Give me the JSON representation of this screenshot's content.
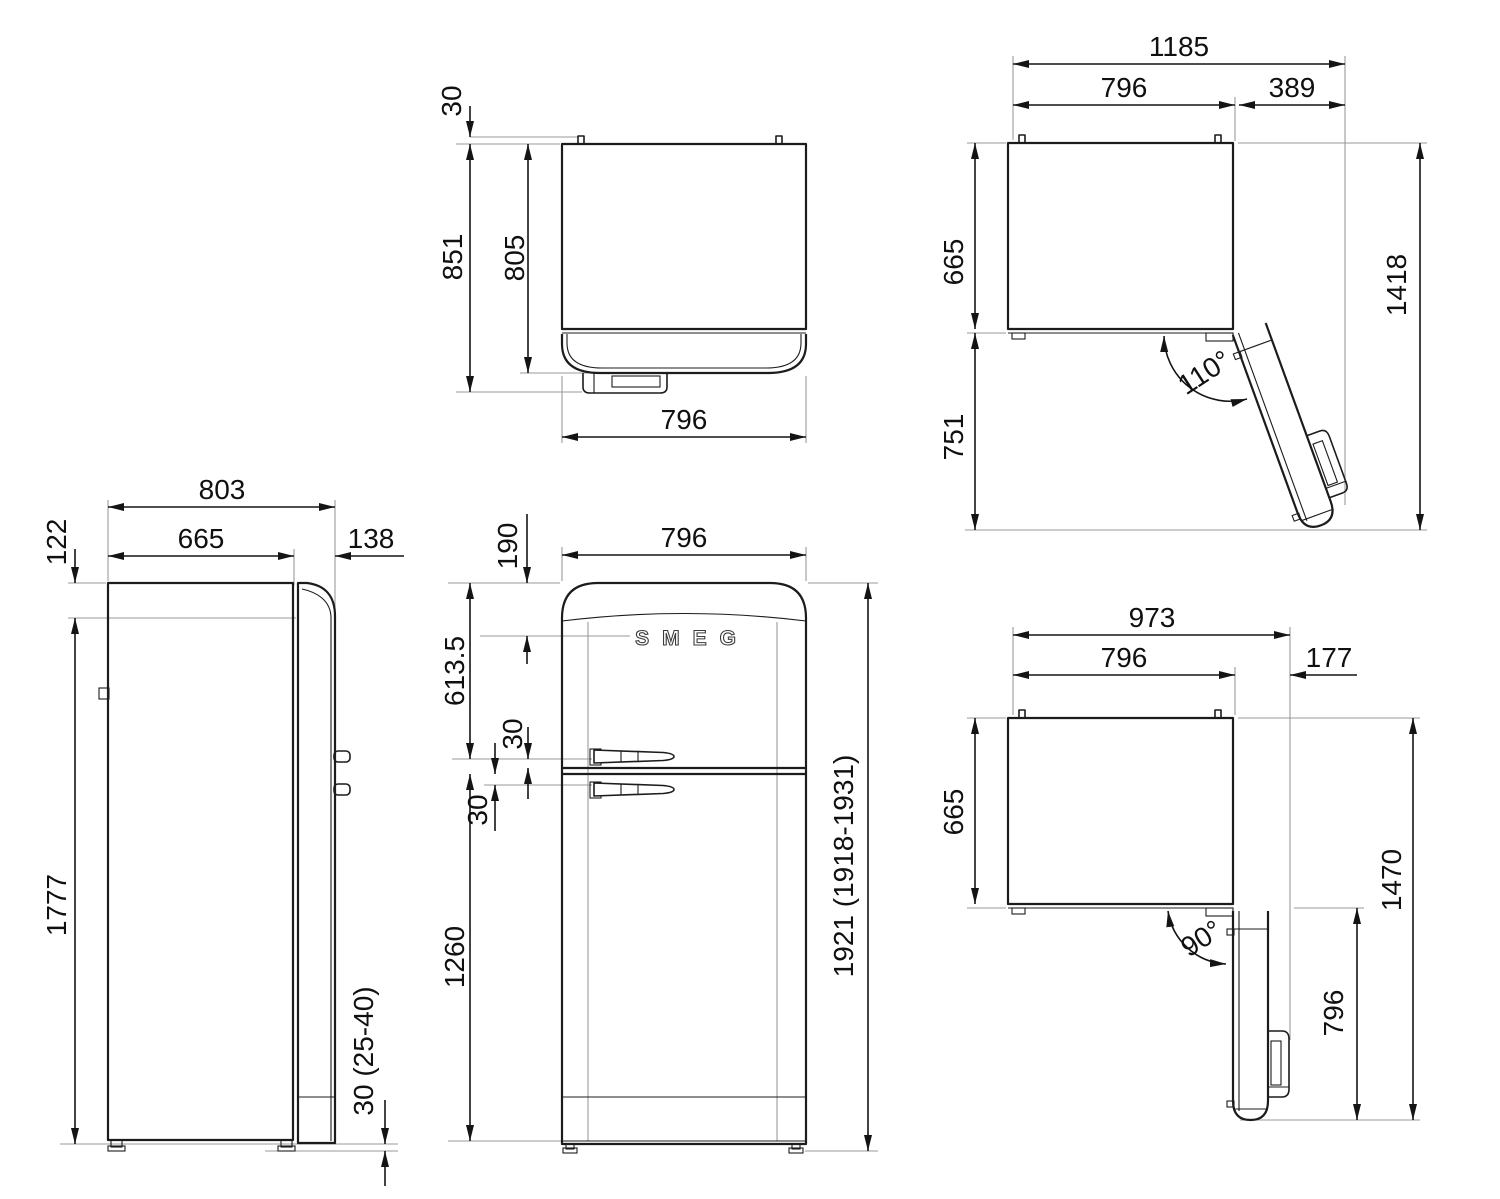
{
  "drawing_type": "refrigerator installation dimension drawing",
  "units": "mm",
  "brand_logo": "SMEG",
  "side": {
    "overall_depth": "803",
    "body_depth": "665",
    "door_depth": "138",
    "top_inset": "122",
    "door_height": "1777",
    "base_clearance": "30 (25-40)"
  },
  "top": {
    "hinge_protrusion": "30",
    "depth_with_handle": "851",
    "depth_without_handle": "805",
    "width": "796"
  },
  "front": {
    "width": "796",
    "top_to_logo": "190",
    "top_to_upper_handle": "613.5",
    "upper_handle_to_split": "30",
    "split_to_lower_handle": "30",
    "split_to_bottom": "1260",
    "overall_height": "1921 (1918-1931)"
  },
  "open110": {
    "overall_width": "1185",
    "cabinet_width": "796",
    "door_overhang": "389",
    "cabinet_depth": "665",
    "door_projection": "751",
    "overall_depth": "1418",
    "opening_angle": "110°"
  },
  "open90": {
    "overall_width": "973",
    "cabinet_width": "796",
    "door_overhang": "177",
    "cabinet_depth": "665",
    "door_length": "796",
    "overall_depth": "1470",
    "opening_angle": "90°"
  }
}
